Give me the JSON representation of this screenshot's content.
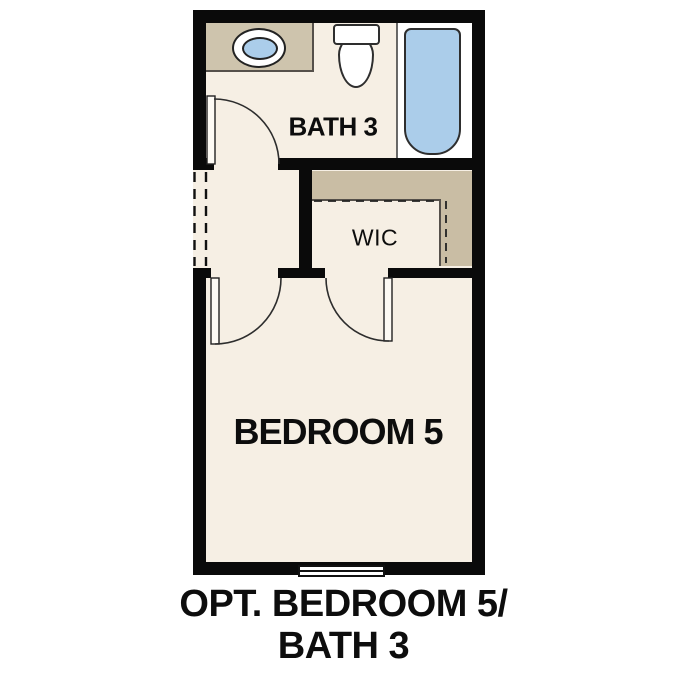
{
  "diagram": {
    "type": "floor-plan",
    "rooms": [
      {
        "id": "bath3",
        "label": "BATH 3"
      },
      {
        "id": "wic",
        "label": "WIC"
      },
      {
        "id": "bedroom5",
        "label": "BEDROOM 5"
      }
    ],
    "fixtures": [
      "vanity-counter",
      "sink",
      "toilet",
      "bathtub",
      "window",
      "bath-door",
      "bedroom-door",
      "wic-door",
      "closet-shelf",
      "closet-rod"
    ],
    "caption": {
      "line1": "OPT. BEDROOM 5/",
      "line2": "BATH 3"
    }
  },
  "colors": {
    "background": "#ffffff",
    "wall": "#0a0a0a",
    "floor": "#f6efe4",
    "counter-tan": "#cec4ad",
    "closet-tan": "#c9bda4",
    "fixture-blue": "#abcdea",
    "text": "#0d0d0d"
  }
}
